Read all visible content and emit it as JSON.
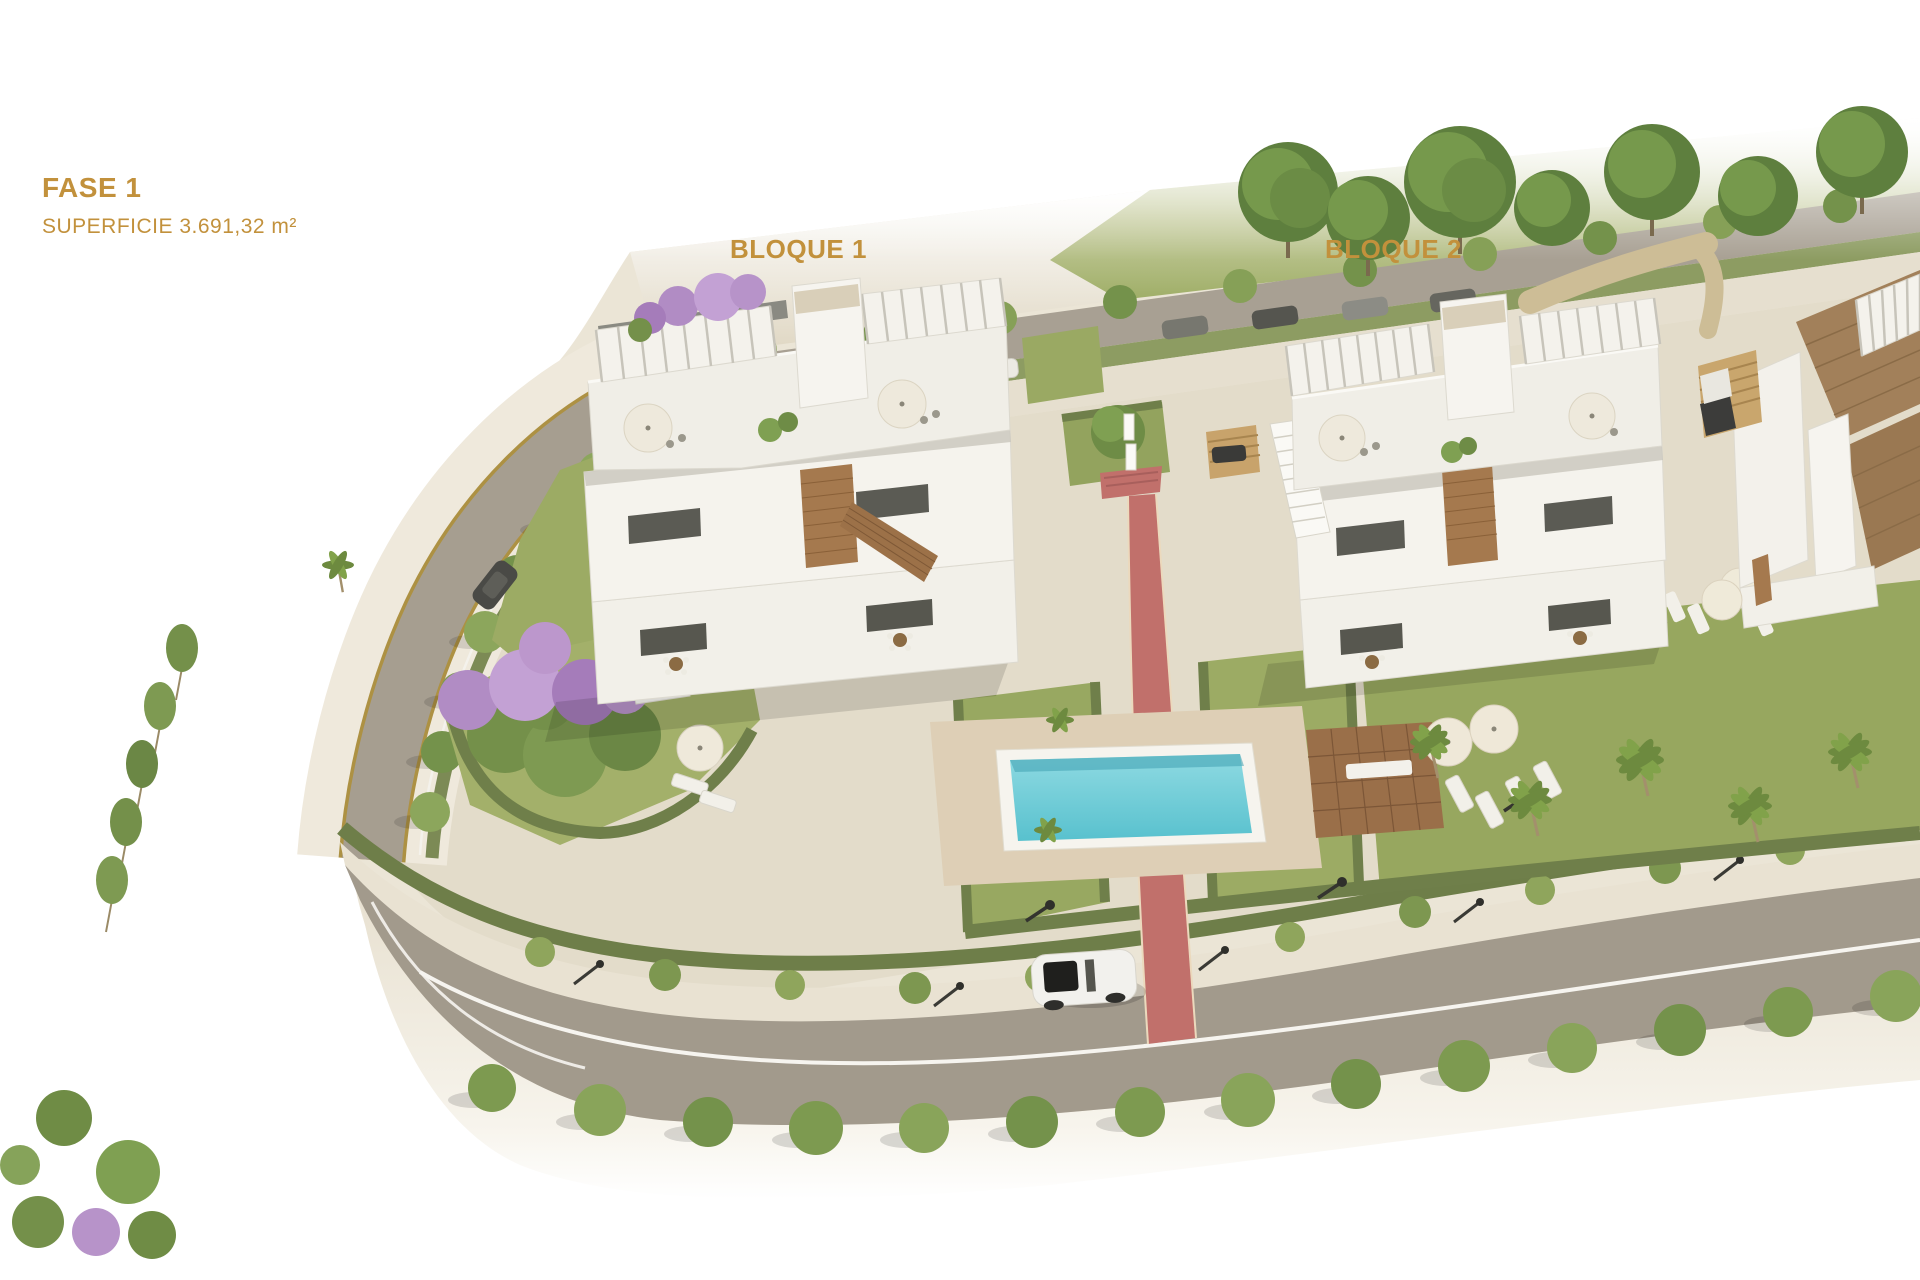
{
  "annotations": {
    "phase_title": "FASE 1",
    "phase_subtitle": "SUPERFICIE 3.691,32 m²",
    "block1_label": "BLOQUE 1",
    "block2_label": "BLOQUE 2",
    "label_color": "#C2913C"
  },
  "palette": {
    "background": "#FFFFFF",
    "ground": "#EBE5D6",
    "plaza": "#E3DCCA",
    "road": "#A49C8E",
    "sidewalk": "#E9E2D2",
    "lawn": "#9CAB64",
    "hedge": "#6F7F4A",
    "street_tree": "#7E9A52",
    "jacaranda": "#B793C9",
    "pool_water": "#7BD0DB",
    "pool_deck": "#DECFB6",
    "jogging_path": "#C1706B",
    "wood_deck": "#9A6F49",
    "building_white": "#F4F2EC",
    "wood_accent": "#A5794E",
    "roof_tile": "#A2805A",
    "car_white": "#F2F1ED"
  }
}
